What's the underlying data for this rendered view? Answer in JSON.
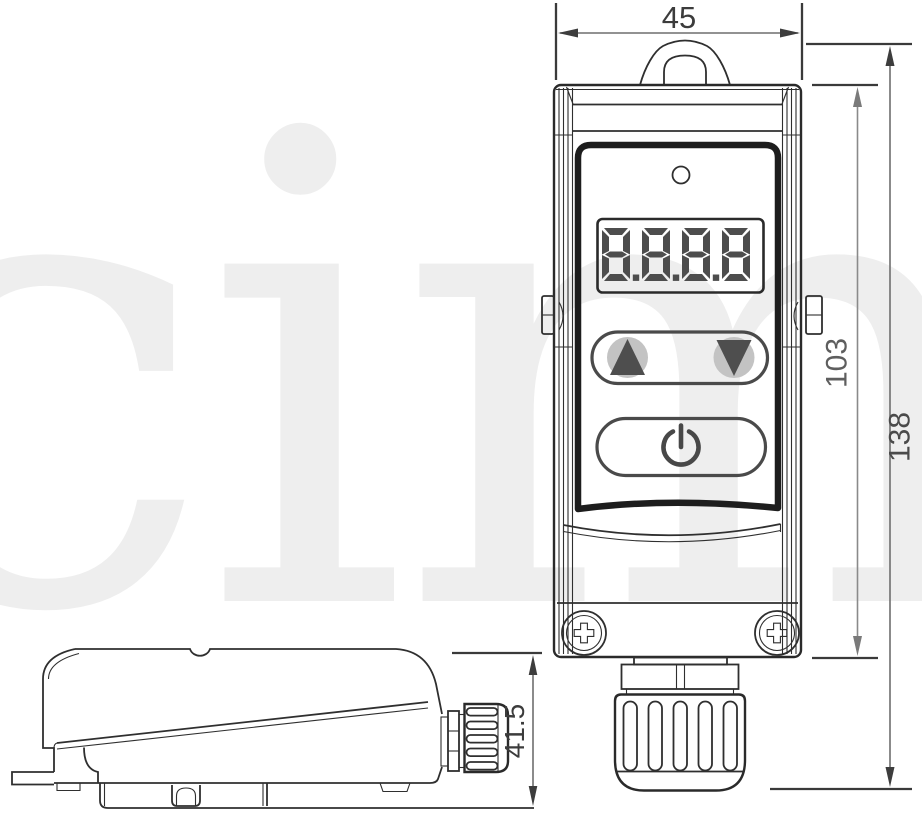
{
  "watermark": {
    "text": "cima"
  },
  "front_view": {
    "display": {
      "value": "8.8.8.8"
    },
    "controls": {
      "up_icon": "▲",
      "down_icon": "▼",
      "power_icon": "⏻"
    },
    "indicator": "led"
  },
  "dimensions": {
    "width_mm": {
      "label": "45"
    },
    "body_height_mm": {
      "label": "103"
    },
    "total_height_mm": {
      "label": "138"
    },
    "depth_mm": {
      "label": "41.5"
    }
  },
  "colors": {
    "line": "#2f2f2f",
    "panel_border": "#1d1d1d",
    "dim_line": "#6e6e6e",
    "dim_text_gray": "#5e5e5e",
    "dim_text_dark": "#3c3c3c",
    "segment": "#4d4d4d",
    "button_fill": "#c3c3c3",
    "watermark": "#eeeeee"
  }
}
